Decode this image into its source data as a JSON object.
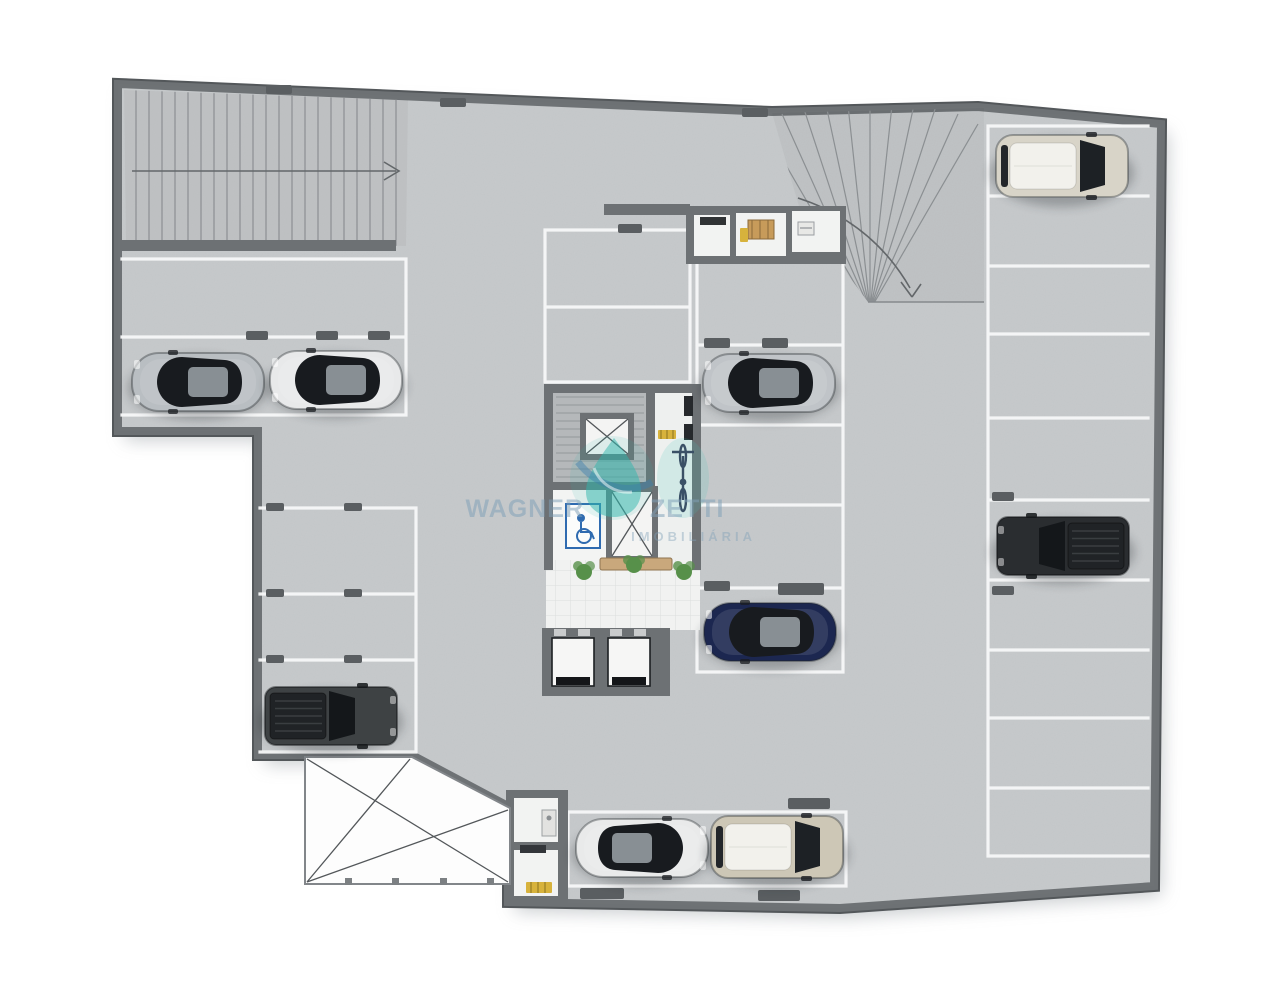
{
  "scene": {
    "type": "architectural-floor-plan",
    "subject": "underground parking garage level, humanized 3D top view",
    "background": "#ffffff",
    "floor_color": "#c7cacc",
    "wall_color": "#6d7174",
    "stall_line_color": "#f7f8f8",
    "ramp_hatch_color": "#8b8f92",
    "pillar_color": "#5a5e61",
    "lobby_tile_color": "#f1f2f1",
    "accent_wood": "#c9a87c",
    "plant_green": "#57904a",
    "accessible_blue": "#2f6bb0",
    "safety_yellow": "#d7b23c",
    "car_count": 9
  },
  "watermark": {
    "name_left": "WAGNER",
    "name_right": "ZETTI",
    "subtitle": "IMOBILIÁRIA",
    "text_color": "#7fa0b8",
    "drop_color": "#2fb5ab",
    "swoosh_color": "#3d7fae"
  },
  "cars": [
    {
      "id": "suv-white-top-right",
      "type": "suv",
      "body_color": "#d8d4c8",
      "facing": "right",
      "stall": "right-column-row-1",
      "transform": "translate(1062 166)"
    },
    {
      "id": "sedan-silver-left",
      "type": "sedan",
      "body_color": "#b9bec2",
      "facing": "left",
      "stall": "left-row",
      "transform": "translate(198 382) scale(-1 1)"
    },
    {
      "id": "sedan-white-left",
      "type": "sedan",
      "body_color": "#e8e9ea",
      "facing": "left",
      "stall": "left-row",
      "transform": "translate(336 380) scale(-1 1)"
    },
    {
      "id": "sedan-silver-center",
      "type": "sedan",
      "body_color": "#c0c4c8",
      "facing": "left",
      "stall": "center-right-column-row-2",
      "transform": "translate(769 383) scale(-1 1)"
    },
    {
      "id": "pickup-black-right",
      "type": "pickup",
      "body_color": "#2a2d30",
      "facing": "left",
      "stall": "right-column-row-6",
      "transform": "translate(1063 546) scale(-1 1)"
    },
    {
      "id": "sedan-navy-center",
      "type": "sedan",
      "body_color": "#1c2750",
      "facing": "left",
      "stall": "center-right-column-row-5",
      "transform": "translate(770 632) scale(-1 1)"
    },
    {
      "id": "pickup-gray-bottom-left",
      "type": "pickup",
      "body_color": "#3e4244",
      "facing": "right",
      "stall": "left-lower-column-row-4",
      "transform": "translate(331 716)"
    },
    {
      "id": "sedan-white-bottom",
      "type": "sedan",
      "body_color": "#e9eaea",
      "facing": "right",
      "stall": "bottom-row",
      "transform": "translate(642 848)"
    },
    {
      "id": "suv-beige-bottom",
      "type": "suv",
      "body_color": "#cdc7b6",
      "facing": "right",
      "stall": "bottom-row",
      "transform": "translate(777 847)"
    }
  ],
  "features": {
    "ramp_left": "straight-ramp-with-arrow",
    "ramp_right": "curved-ramp-with-arrow",
    "core": "stair-elevator-core",
    "accessible_wc": "wheelchair-floor-sign",
    "bike_rack": "bicycle",
    "void": "open-shaft-x-marked",
    "elevators": 2
  }
}
